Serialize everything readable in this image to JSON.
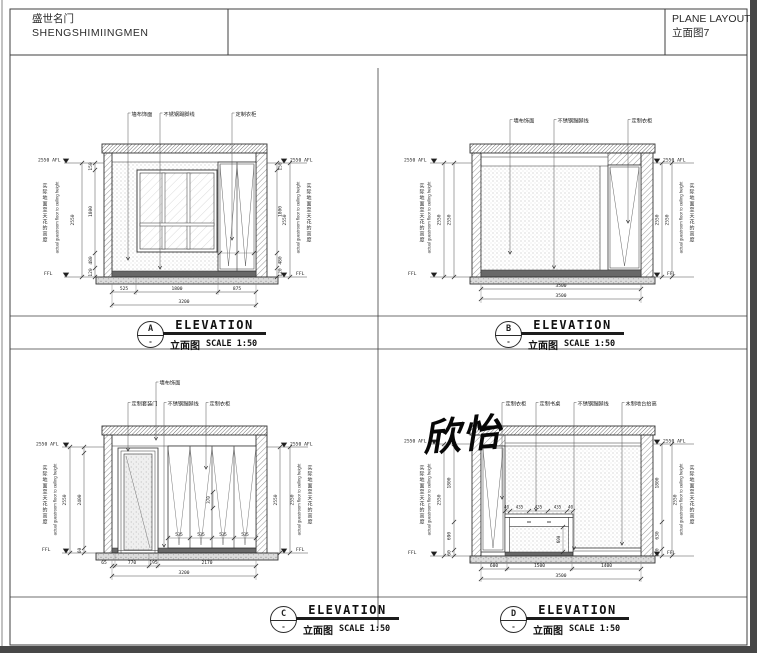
{
  "sheet": {
    "project_name_cn": "盛世名门",
    "project_name_en": "SHENGSHIMIINGMEN",
    "sheet_title": "PLANE LAYOUT",
    "sheet_subtitle": "立面图7"
  },
  "watermark": "欣怡",
  "labels": {
    "elevation": "ELEVATION",
    "plan_cn": "立面图",
    "scale": "SCALE 1:50",
    "afl": "2550 AFL",
    "ffl": "FFL",
    "height_cn": "实际地面至天花的高度",
    "height_en": "actual guestroom floor to ceiling height",
    "dash": "-"
  },
  "elev": {
    "A": {
      "letter": "A",
      "callouts": [
        "墙布饰面",
        "不锈钢踢脚线",
        "定制衣柜"
      ],
      "vdims": [
        "150",
        "1800",
        "480",
        "120"
      ],
      "vtotal": "2550",
      "hdims": [
        "525",
        "1800",
        "875"
      ],
      "htotal": "3200"
    },
    "B": {
      "letter": "B",
      "callouts": [
        "墙布饰面",
        "不锈钢踢脚线",
        "定制衣柜"
      ],
      "vtotal": "2550",
      "hdims": [
        "3500"
      ],
      "htotal": "3500"
    },
    "C": {
      "letter": "C",
      "callouts": [
        "墙布饰面",
        "定制套装门",
        "不锈钢踢脚线",
        "定制衣柜"
      ],
      "vdims": [
        "2400",
        "60"
      ],
      "vtotal": "2550",
      "hdims": [
        "65",
        "770",
        "195",
        "2170"
      ],
      "htotal": "3200",
      "panel_dims": [
        "535",
        "535",
        "535",
        "535"
      ],
      "inner_dim": "370"
    },
    "D": {
      "letter": "D",
      "callouts": [
        "定制衣柜",
        "定制书桌",
        "不锈钢踢脚线",
        "木制地台抬高"
      ],
      "vdims_left": [
        "1800",
        "690",
        "60"
      ],
      "vdims_right": [
        "1800",
        "630",
        "120"
      ],
      "vtotal": "2550",
      "hdims": [
        "600",
        "1500",
        "1400"
      ],
      "htotal": "3500",
      "desk_dims": [
        "40",
        "435",
        "435",
        "435",
        "40"
      ],
      "desk_vdim": "600"
    }
  }
}
